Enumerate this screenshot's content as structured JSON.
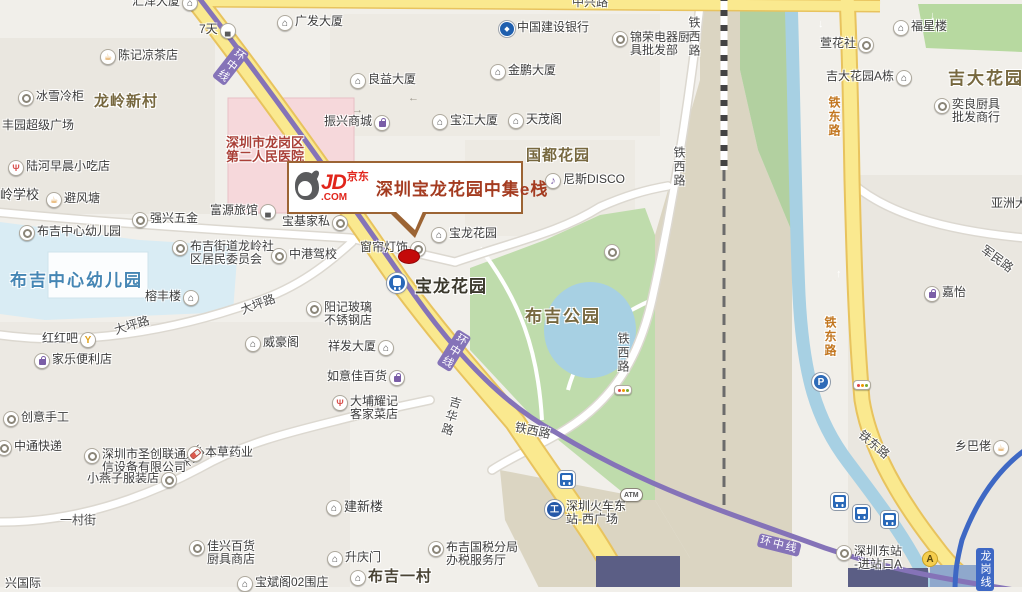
{
  "callout": {
    "logo_jd": "JD",
    "logo_jingdong": "京东",
    "logo_com": ".COM",
    "title": "深圳宝龙花园中集e栈"
  },
  "colors": {
    "road_yellow": "#FAE98F",
    "road_casing": "#E8C35E",
    "metro_purple": "#8573B8",
    "metro_blue": "#3E68C4",
    "water": "#A7D0E3",
    "park_green": "#BFDCAC",
    "hospital_pink": "#F6D8DB",
    "school_blue": "#D9ECF4",
    "jd_red": "#E1251B",
    "callout_border": "#9C6434",
    "marker_red": "#C40A0A"
  },
  "icon_glyphs": {
    "bldg": "⌂",
    "cup": "☕",
    "food": "Ψ",
    "bar": "Y",
    "mic": "♪",
    "bed": "▄",
    "rail": "工",
    "parking": "P",
    "exitA": "A",
    "atm": "ATM",
    "bank": "◆"
  },
  "pois": [
    {
      "x": 132,
      "y": -5,
      "icon": "bldg",
      "side": "r",
      "lines": [
        "汇泽大厦"
      ]
    },
    {
      "x": 199,
      "y": 23,
      "icon": "bed",
      "side": "r",
      "lines": [
        "7天"
      ]
    },
    {
      "x": 275,
      "y": 15,
      "icon": "bldg",
      "side": "l",
      "lines": [
        "广发大厦"
      ]
    },
    {
      "x": 98,
      "y": 49,
      "icon": "cup",
      "side": "l",
      "lines": [
        "陈记凉茶店"
      ]
    },
    {
      "x": 16,
      "y": 90,
      "icon": "dot",
      "side": "l",
      "lines": [
        "冰雪冷柜"
      ]
    },
    {
      "x": 497,
      "y": 21,
      "icon": "bank",
      "side": "l",
      "lines": [
        "中国建设银行"
      ]
    },
    {
      "x": 610,
      "y": 31,
      "icon": "dot",
      "side": "l",
      "lines": [
        "锦荣电器厨",
        "具批发部"
      ]
    },
    {
      "x": 348,
      "y": 73,
      "icon": "bldg",
      "side": "l",
      "lines": [
        "良益大厦"
      ]
    },
    {
      "x": 488,
      "y": 64,
      "icon": "bldg",
      "side": "l",
      "lines": [
        "金鹏大厦"
      ]
    },
    {
      "x": 324,
      "y": 115,
      "icon": "bag",
      "side": "r",
      "lines": [
        "振兴商城"
      ]
    },
    {
      "x": 430,
      "y": 114,
      "icon": "bldg",
      "side": "l",
      "lines": [
        "宝江大厦"
      ]
    },
    {
      "x": 506,
      "y": 113,
      "icon": "bldg",
      "side": "l",
      "lines": [
        "天茂阁"
      ]
    },
    {
      "x": 543,
      "y": 173,
      "icon": "mic",
      "side": "l",
      "lines": [
        "尼斯DISCO"
      ]
    },
    {
      "x": 820,
      "y": 37,
      "icon": "dot",
      "side": "r",
      "lines": [
        "萱花社"
      ]
    },
    {
      "x": 891,
      "y": 20,
      "icon": "bldg",
      "side": "l",
      "lines": [
        "福星楼"
      ]
    },
    {
      "x": 826,
      "y": 70,
      "icon": "bldg",
      "side": "r",
      "lines": [
        "吉大花园A栋"
      ]
    },
    {
      "x": 932,
      "y": 98,
      "icon": "dot",
      "side": "l",
      "lines": [
        "奕良厨具",
        "批发商行"
      ]
    },
    {
      "x": 6,
      "y": 160,
      "icon": "food",
      "side": "l",
      "lines": [
        "陆河早晨小吃店"
      ]
    },
    {
      "x": 0,
      "y": 188,
      "icon": "none",
      "side": "l",
      "lines": [
        "岭学校"
      ],
      "cls": "t-plain13"
    },
    {
      "x": 44,
      "y": 192,
      "icon": "cup",
      "side": "l",
      "lines": [
        "避风塘"
      ]
    },
    {
      "x": 130,
      "y": 212,
      "icon": "dot",
      "side": "l",
      "lines": [
        "强兴五金"
      ]
    },
    {
      "x": 210,
      "y": 204,
      "icon": "bed",
      "side": "r",
      "lines": [
        "富源旅馆"
      ]
    },
    {
      "x": 226,
      "y": 136,
      "icon": "none",
      "side": "l",
      "lines": [
        "深圳市龙岗区",
        "第二人民医院"
      ],
      "cls": "t-hosp"
    },
    {
      "x": 17,
      "y": 225,
      "icon": "dot",
      "side": "l",
      "lines": [
        "布吉中心幼儿园"
      ]
    },
    {
      "x": 170,
      "y": 240,
      "icon": "dot",
      "side": "l",
      "lines": [
        "布吉街道龙岭社",
        "区居民委员会"
      ]
    },
    {
      "x": 269,
      "y": 248,
      "icon": "dot",
      "side": "l",
      "lines": [
        "中港驾校"
      ]
    },
    {
      "x": 282,
      "y": 215,
      "icon": "dot",
      "side": "r",
      "lines": [
        "宝基家私"
      ]
    },
    {
      "x": 360,
      "y": 241,
      "icon": "dot",
      "side": "r",
      "lines": [
        "窗帘灯饰"
      ]
    },
    {
      "x": 429,
      "y": 227,
      "icon": "bldg",
      "side": "l",
      "lines": [
        "宝龙花园"
      ]
    },
    {
      "x": 145,
      "y": 290,
      "icon": "bldg",
      "side": "r",
      "lines": [
        "榕丰楼"
      ]
    },
    {
      "x": 304,
      "y": 301,
      "icon": "dot",
      "side": "l",
      "lines": [
        "阳记玻璃",
        "不锈钢店"
      ]
    },
    {
      "x": 328,
      "y": 340,
      "icon": "bldg",
      "side": "r",
      "lines": [
        "祥发大厦"
      ]
    },
    {
      "x": 327,
      "y": 370,
      "icon": "bag",
      "side": "r",
      "lines": [
        "如意佳百货"
      ]
    },
    {
      "x": 330,
      "y": 395,
      "icon": "food",
      "side": "l",
      "lines": [
        "大埔耀记",
        "客家菜店"
      ]
    },
    {
      "x": 243,
      "y": 336,
      "icon": "bldg",
      "side": "l",
      "lines": [
        "威豪阁"
      ]
    },
    {
      "x": 42,
      "y": 332,
      "icon": "bar",
      "side": "r",
      "lines": [
        "红红吧"
      ]
    },
    {
      "x": 32,
      "y": 353,
      "icon": "bag",
      "side": "l",
      "lines": [
        "家乐便利店"
      ]
    },
    {
      "x": 1,
      "y": 411,
      "icon": "dot",
      "side": "l",
      "lines": [
        "创意手工"
      ]
    },
    {
      "x": -6,
      "y": 440,
      "icon": "dot",
      "side": "l",
      "lines": [
        "中通快递"
      ]
    },
    {
      "x": 82,
      "y": 448,
      "icon": "dot",
      "side": "l",
      "lines": [
        "深圳市圣创联通",
        "信设备有限公司"
      ]
    },
    {
      "x": 185,
      "y": 446,
      "icon": "pill",
      "side": "l",
      "lines": [
        "本草药业"
      ]
    },
    {
      "x": 87,
      "y": 472,
      "icon": "dot",
      "side": "r",
      "lines": [
        "小燕子服装店"
      ]
    },
    {
      "x": 187,
      "y": 540,
      "icon": "dot",
      "side": "l",
      "lines": [
        "佳兴百货",
        "厨具商店"
      ]
    },
    {
      "x": 324,
      "y": 500,
      "icon": "bldg",
      "side": "l",
      "lines": [
        "建新楼"
      ],
      "cls": "t-plain13"
    },
    {
      "x": 325,
      "y": 551,
      "icon": "bldg",
      "side": "l",
      "lines": [
        "升庆门"
      ]
    },
    {
      "x": 235,
      "y": 576,
      "icon": "bldg",
      "side": "l",
      "lines": [
        "宝斌阁02围庄"
      ]
    },
    {
      "x": 426,
      "y": 541,
      "icon": "dot",
      "side": "l",
      "lines": [
        "布吉国税分局",
        "办税服务厅"
      ]
    },
    {
      "x": 348,
      "y": 570,
      "icon": "bldg",
      "side": "l",
      "lines": [
        "布吉一村"
      ],
      "cls": "t-bold15"
    },
    {
      "x": 543,
      "y": 500,
      "icon": "rail",
      "side": "l",
      "lines": [
        "深圳火车东",
        "站-西广场"
      ]
    },
    {
      "x": 834,
      "y": 545,
      "icon": "dot",
      "side": "l",
      "lines": [
        "深圳东站",
        "-进站口A"
      ]
    },
    {
      "x": 955,
      "y": 440,
      "icon": "cup",
      "side": "r",
      "lines": [
        "乡巴佬"
      ]
    },
    {
      "x": 922,
      "y": 286,
      "icon": "bag",
      "side": "l",
      "lines": [
        "嘉怡"
      ]
    },
    {
      "x": 991,
      "y": 197,
      "icon": "none",
      "side": "l",
      "lines": [
        "亚洲大"
      ]
    },
    {
      "x": 2,
      "y": 119,
      "icon": "none",
      "side": "l",
      "lines": [
        "丰园超级广场"
      ]
    },
    {
      "x": 5,
      "y": 577,
      "icon": "none",
      "side": "l",
      "lines": [
        "兴国际"
      ]
    },
    {
      "x": 618,
      "y": 488,
      "icon": "atm",
      "side": "l",
      "lines": []
    },
    {
      "x": 810,
      "y": 373,
      "icon": "parking",
      "side": "l",
      "lines": []
    },
    {
      "x": 920,
      "y": 551,
      "icon": "exitA",
      "side": "l",
      "lines": []
    },
    {
      "x": 556,
      "y": 471,
      "icon": "bus",
      "side": "l",
      "lines": []
    },
    {
      "x": 829,
      "y": 493,
      "icon": "bus",
      "side": "l",
      "lines": []
    },
    {
      "x": 851,
      "y": 505,
      "icon": "bus",
      "side": "l",
      "lines": []
    },
    {
      "x": 879,
      "y": 511,
      "icon": "bus",
      "side": "l",
      "lines": []
    },
    {
      "x": 385,
      "y": 273,
      "icon": "metro",
      "side": "l",
      "lines": []
    },
    {
      "x": 602,
      "y": 244,
      "icon": "dot",
      "side": "l",
      "lines": []
    },
    {
      "x": 612,
      "y": 385,
      "icon": "signal",
      "side": "l",
      "lines": []
    },
    {
      "x": 851,
      "y": 380,
      "icon": "signal",
      "side": "l",
      "lines": []
    }
  ],
  "labels": [
    {
      "x": 94,
      "y": 90,
      "text": "龙岭新村",
      "cls": "t-olive15"
    },
    {
      "x": 526,
      "y": 144,
      "text": "国都花园",
      "cls": "t-olive15"
    },
    {
      "x": 948,
      "y": 64,
      "text": "吉大花园",
      "cls": "t-olive17"
    },
    {
      "x": 525,
      "y": 302,
      "text": "布吉公园",
      "cls": "t-olive17"
    },
    {
      "x": 10,
      "y": 266,
      "text": "布吉中心幼儿园",
      "cls": "t-blue17"
    },
    {
      "x": 415,
      "y": 272,
      "text": "宝龙花园",
      "cls": "t-station"
    },
    {
      "x": 112,
      "y": 322,
      "text": "大坪路",
      "cls": "t-road",
      "rot": -17
    },
    {
      "x": 238,
      "y": 302,
      "text": "大坪路",
      "cls": "t-road",
      "rot": -20
    },
    {
      "x": 170,
      "y": 466,
      "text": "一村街",
      "cls": "t-road",
      "rot": -43
    },
    {
      "x": 60,
      "y": 511,
      "text": "一村街",
      "cls": "t-road"
    },
    {
      "x": 686,
      "y": 16,
      "text": "铁西路",
      "cls": "t-road t-vert"
    },
    {
      "x": 671,
      "y": 146,
      "text": "铁西路",
      "cls": "t-road t-vert"
    },
    {
      "x": 615,
      "y": 332,
      "text": "铁西路",
      "cls": "t-road t-vert"
    },
    {
      "x": 517,
      "y": 418,
      "text": "铁西路",
      "cls": "t-road",
      "rot": 12
    },
    {
      "x": 826,
      "y": 96,
      "text": "铁东路",
      "cls": "t-road t-road-org t-vert"
    },
    {
      "x": 822,
      "y": 316,
      "text": "铁东路",
      "cls": "t-road t-road-org t-vert"
    },
    {
      "x": 866,
      "y": 426,
      "text": "铁东路",
      "cls": "t-road",
      "rot": 40
    },
    {
      "x": 449,
      "y": 394,
      "text": "吉华路",
      "cls": "t-road t-vert",
      "rot": 16
    },
    {
      "x": 988,
      "y": 241,
      "text": "军民路",
      "cls": "t-road",
      "rot": 36
    },
    {
      "x": 572,
      "y": -7,
      "text": "中兴路",
      "cls": "t-road"
    },
    {
      "x": 237,
      "y": 44,
      "text": "环中线",
      "cls": "t-mline t-vert",
      "rot": 38
    },
    {
      "x": 458,
      "y": 329,
      "text": "环中线",
      "cls": "t-mline t-vert",
      "rot": 32
    },
    {
      "x": 760,
      "y": 533,
      "text": "环中线",
      "cls": "t-mline",
      "rot": 14
    },
    {
      "x": 976,
      "y": 548,
      "text": "龙岗线",
      "cls": "t-bline"
    },
    {
      "x": 408,
      "y": 92,
      "text": "←",
      "cls": "t-arrow"
    },
    {
      "x": 352,
      "y": 104,
      "text": "→",
      "cls": "t-arrow"
    },
    {
      "x": 818,
      "y": 18,
      "text": "↓",
      "cls": "t-arrow-y"
    },
    {
      "x": 836,
      "y": 268,
      "text": "↑",
      "cls": "t-arrow-y"
    },
    {
      "x": 930,
      "y": 10,
      "text": "↓",
      "cls": "t-arrow-y"
    },
    {
      "x": 692,
      "y": 28,
      "text": "↓",
      "cls": "t-arrow"
    }
  ]
}
